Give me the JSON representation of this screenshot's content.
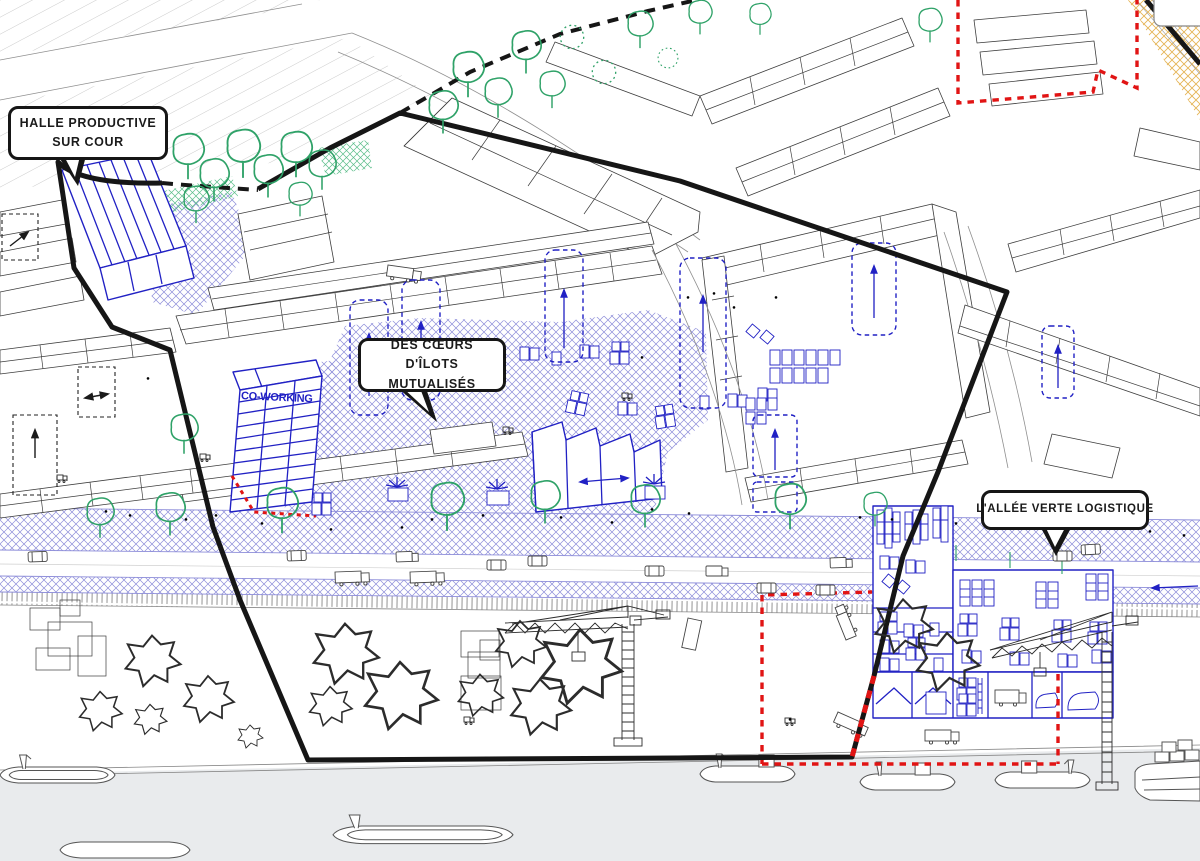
{
  "drawing": {
    "annotations": {
      "halle": "HALLE PRODUCTIVE SUR COUR",
      "coeurs": "DES CŒURS D'ÎLOTS MUTUALISÉS",
      "allee": "L'ALLÉE VERTE LOGISTIQUE",
      "coworking": "CO-WORKING"
    },
    "colors": {
      "project_blue": "#2121c4",
      "hatch_blue": "#8d8dd9",
      "tree_green": "#2fa268",
      "alert_red": "#e11414",
      "boundary_black": "#161616",
      "sand_yellow": "#e5b455",
      "river_gray": "#e9ebed",
      "building_gray": "#3d3d3d"
    }
  }
}
